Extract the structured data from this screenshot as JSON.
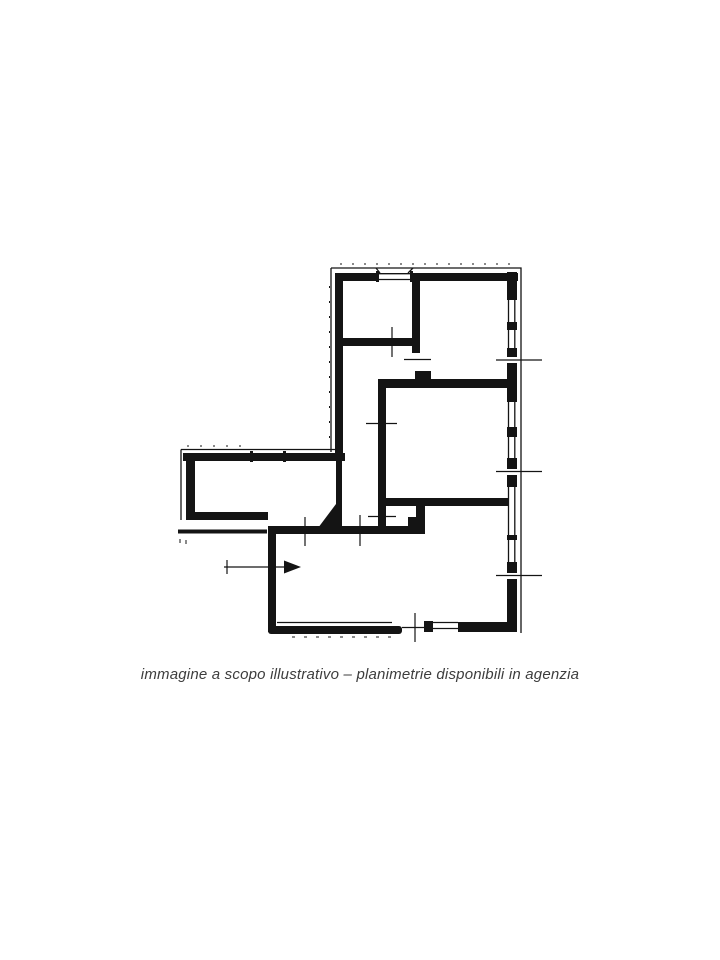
{
  "page": {
    "background_color": "#ffffff"
  },
  "figure": {
    "type": "floor-plan",
    "description": "scanned black-and-white apartment floor plan, L-shaped layout",
    "ink_color": "#141414",
    "caption": "immagine a scopo illustrativo – planimetrie disponibili in agenzia",
    "caption_color": "#3d3d3d",
    "elements": [
      "exterior-walls",
      "interior-walls",
      "window-markers",
      "door-openings",
      "dimension-ticks",
      "entrance-arrow"
    ]
  }
}
